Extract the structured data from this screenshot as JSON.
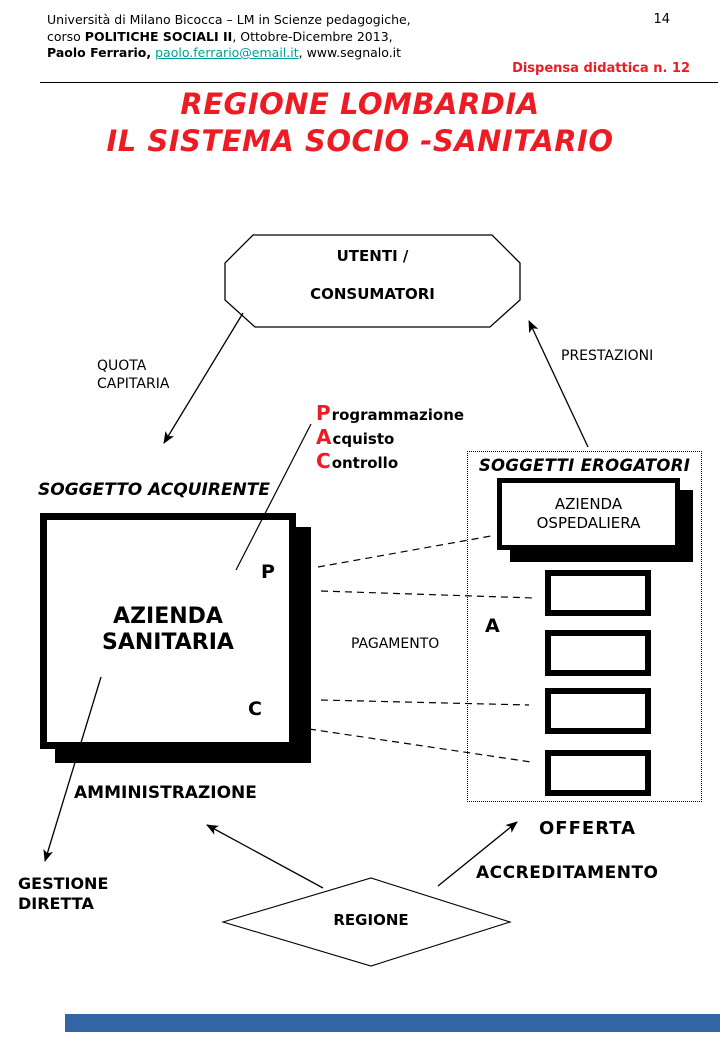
{
  "header": {
    "page_number": "14",
    "line1": "Università di Milano Bicocca – LM in Scienze pedagogiche,",
    "line2": {
      "prefix": "corso ",
      "bold": "POLITICHE SOCIALI II",
      "suffix": ", Ottobre-Dicembre 2013,"
    },
    "line3": {
      "bold": "Paolo Ferrario,",
      "link": "paolo.ferrario@email.it",
      "suffix": ", www.segnalo.it"
    },
    "badge": "Dispensa didattica n. 12"
  },
  "title": {
    "line1": "REGIONE LOMBARDIA",
    "line2": "IL SISTEMA SOCIO -SANITARIO"
  },
  "diagram": {
    "utenti_line1": "UTENTI /",
    "utenti_line2": "CONSUMATORI",
    "quota_line1": "QUOTA",
    "quota_line2": "CAPITARIA",
    "prestazioni": "PRESTAZIONI",
    "pac": [
      {
        "initial": "P",
        "rest": "rogrammazione"
      },
      {
        "initial": "A",
        "rest": "cquisto"
      },
      {
        "initial": "C",
        "rest": "ontrollo"
      }
    ],
    "soggetto_acquirente": "SOGGETTO ACQUIRENTE",
    "soggetti_erogatori": "SOGGETTI EROGATORI",
    "azienda_sanitaria_line1": "AZIENDA",
    "azienda_sanitaria_line2": "SANITARIA",
    "azienda_ospedaliera_line1": "AZIENDA",
    "azienda_ospedaliera_line2": "OSPEDALIERA",
    "letter_p": "P",
    "letter_a": "A",
    "letter_c": "C",
    "pagamento": "PAGAMENTO",
    "amministrazione": "AMMINISTRAZIONE",
    "gestione_line1": "GESTIONE",
    "gestione_line2": "DIRETTA",
    "offerta": "OFFERTA",
    "accreditamento": "ACCREDITAMENTO",
    "regione": "REGIONE"
  },
  "colors": {
    "accent_red": "#ed1c24",
    "link_teal": "#00a099",
    "footer_blue": "#3465a4",
    "ink": "#000000",
    "paper": "#ffffff"
  }
}
